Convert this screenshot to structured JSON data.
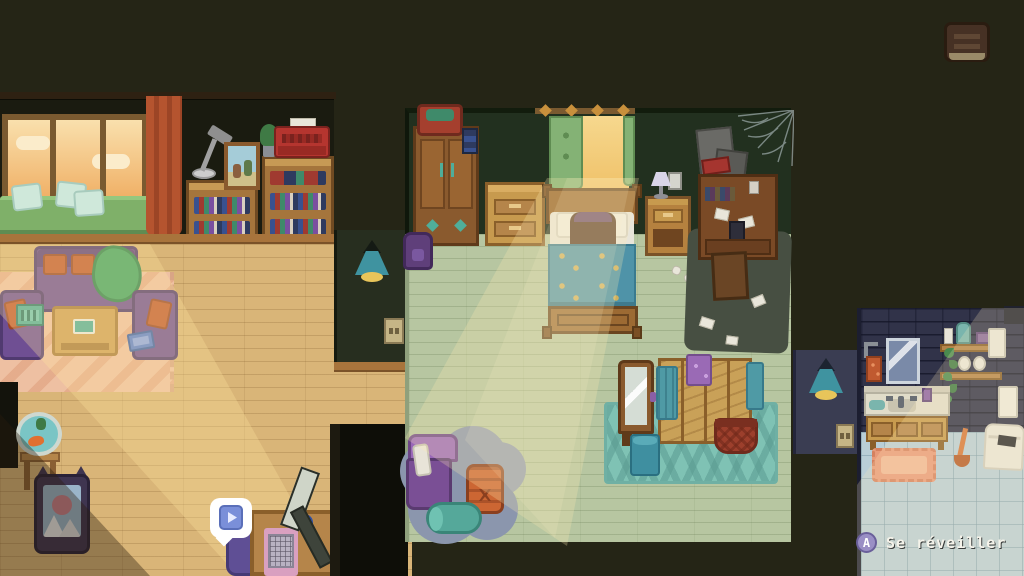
{
  "ui": {
    "journal_button": {
      "icon": "journal-book-icon"
    },
    "thought_bubble": {
      "icon": "play-media-icon"
    },
    "wake_prompt": {
      "button_label": "A",
      "action_label": "Se réveiller"
    }
  },
  "palette": {
    "outside_dark": "#252516",
    "living_wall": "#1a1b10",
    "living_floor": "#d9b578",
    "sunset_window": "#f0b066",
    "sofa_purple": "#6f4f93",
    "pillow_orange": "#c05a2e",
    "blanket_green": "#3fa463",
    "rug_pink": "#eec0a2",
    "bedroom_wall": "#22301f",
    "bedroom_floor": "#b7c6a1",
    "bed_blanket_teal": "#4f93a8",
    "wood_furniture": "#c79a4e",
    "curtain_green": "#84b275",
    "curtain_red": "#b5542f",
    "cloud_rug_blue": "#8b96ad",
    "gaming_chair_purple": "#9a68b8",
    "pouf_orange": "#cc6633",
    "hall_wall_left": "#272e1f",
    "hall_wall_right": "#3a3d52",
    "lamp_teal": "#3f93a0",
    "lamp_glow": "#e8c55a",
    "bathroom_wall": "#313349",
    "bathroom_floor": "#b9ced7",
    "bath_mat": "#e89a7a",
    "light_beam": "#ffe8b0",
    "prompt_text": "#f5f3ea",
    "prompt_button_bg": "#9a8fc5"
  },
  "scene": {
    "rooms": [
      {
        "name": "living-room",
        "objects": [
          "sunset-window",
          "window-bench",
          "bench-pillows",
          "red-curtain",
          "desk-lamp",
          "photo-frame",
          "bookshelves",
          "typewriter",
          "plant",
          "sofa",
          "throw-pillows",
          "green-blanket",
          "armchair-left",
          "laptop",
          "armchair-right",
          "tablet",
          "coffee-table",
          "pink-rug",
          "fishbowl",
          "cat-picture",
          "computer-desk",
          "monitor",
          "keyboard",
          "mug",
          "desk-chair"
        ]
      },
      {
        "name": "hallway",
        "objects": [
          "pendant-lamp",
          "light-switch",
          "dark-doorway"
        ]
      },
      {
        "name": "bedroom",
        "objects": [
          "wardrobe",
          "suitcase",
          "backpack",
          "dresser",
          "lit-window",
          "green-curtains",
          "bed",
          "sleeping-character",
          "teal-blanket",
          "nightstand",
          "table-lamp",
          "light-switch",
          "posters",
          "cobweb",
          "cluttered-desk",
          "desk-chair",
          "dark-rug",
          "scattered-papers",
          "standing-mirror",
          "chevron-rug",
          "folding-screen",
          "towels",
          "laundry-basket",
          "waste-bin",
          "cloud-rug",
          "gaming-chair",
          "pouf",
          "bolster-pillow"
        ]
      },
      {
        "name": "bathroom",
        "objects": [
          "brick-wall",
          "mirror",
          "towel-ring",
          "wall-shelf",
          "toiletries",
          "hanging-plant",
          "towels",
          "sink-vanity",
          "bath-mat",
          "tile-floor",
          "plunger",
          "hamper"
        ]
      }
    ]
  }
}
